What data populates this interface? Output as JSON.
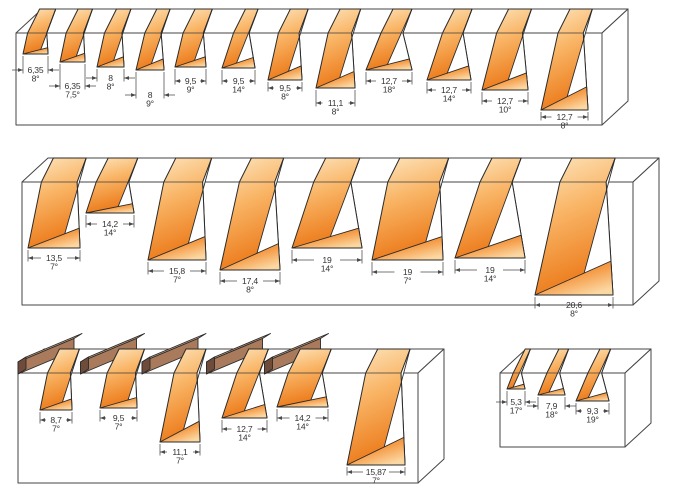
{
  "rows": [
    {
      "id": "row-1",
      "cuts": [
        {
          "mm": "6,35",
          "angle": "8°"
        },
        {
          "mm": "6,35",
          "angle": "7,5°"
        },
        {
          "mm": "8",
          "angle": "8°"
        },
        {
          "mm": "8",
          "angle": "9°"
        },
        {
          "mm": "9,5",
          "angle": "9°"
        },
        {
          "mm": "9,5",
          "angle": "14°"
        },
        {
          "mm": "9,5",
          "angle": "8°"
        },
        {
          "mm": "11,1",
          "angle": "8°"
        },
        {
          "mm": "12,7",
          "angle": "18°"
        },
        {
          "mm": "12,7",
          "angle": "14°"
        },
        {
          "mm": "12,7",
          "angle": "10°"
        },
        {
          "mm": "12,7",
          "angle": "8°"
        }
      ]
    },
    {
      "id": "row-2",
      "cuts": [
        {
          "mm": "13,5",
          "angle": "7°"
        },
        {
          "mm": "14,2",
          "angle": "14°"
        },
        {
          "mm": "15,8",
          "angle": "7°"
        },
        {
          "mm": "17,4",
          "angle": "8°"
        },
        {
          "mm": "19",
          "angle": "14°"
        },
        {
          "mm": "19",
          "angle": "7°"
        },
        {
          "mm": "19",
          "angle": "14°"
        },
        {
          "mm": "20,6",
          "angle": "8°"
        }
      ]
    },
    {
      "id": "row-3",
      "cuts": [
        {
          "mm": "8,7",
          "angle": "7°"
        },
        {
          "mm": "9,5",
          "angle": "7°"
        },
        {
          "mm": "11,1",
          "angle": "7°"
        },
        {
          "mm": "12,7",
          "angle": "14°"
        },
        {
          "mm": "14,2",
          "angle": "14°"
        },
        {
          "mm": "15,87",
          "angle": "7°"
        }
      ]
    },
    {
      "id": "row-4",
      "cuts": [
        {
          "mm": "5,3",
          "angle": "17°"
        },
        {
          "mm": "7,9",
          "angle": "18°"
        },
        {
          "mm": "9,3",
          "angle": "19°"
        }
      ]
    }
  ],
  "colors": {
    "profile_light": "#FDE7C2",
    "profile_mid": "#F9B566",
    "profile_deep": "#EC7A1A",
    "floor_dark": "#DE6E10",
    "floor_mid": "#F59C47",
    "floor_light": "#FBD7A2",
    "wood_front": "#A97A5B",
    "wood_top": "#C9A07F",
    "wood_end": "#6F4C39",
    "outline": "#2B2B2B",
    "block_line": "#454545",
    "dim_line": "#4A4A4A",
    "text": "#333333",
    "background": "#FFFFFF"
  }
}
